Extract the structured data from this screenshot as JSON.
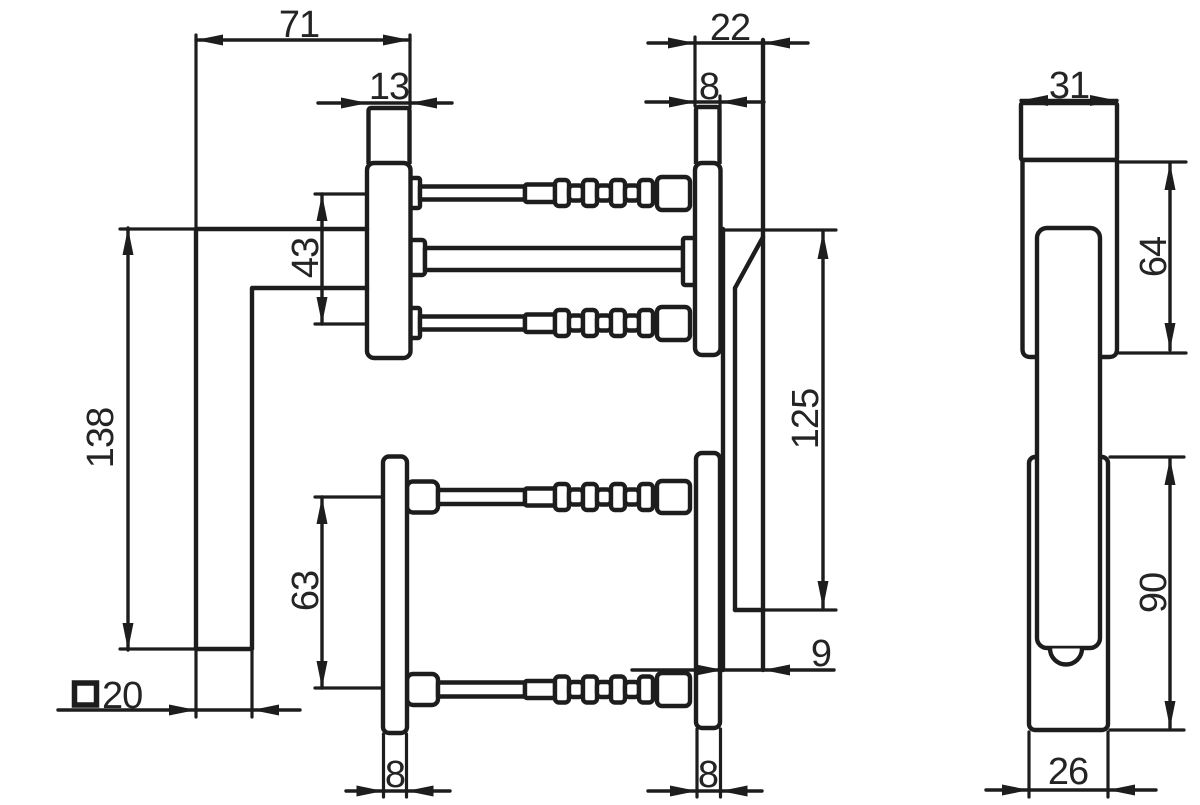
{
  "drawing": {
    "type": "technical-drawing-door-window-handle",
    "background_color": "#ffffff",
    "line_color": "#1d1d1d",
    "dims": {
      "handle_projection": "71",
      "rosette_thickness": "13",
      "screw_spacing_top": "43",
      "handle_height": "138",
      "grip_square_size": "20",
      "screw_spacing_bottom": "63",
      "rosette_width_bottom_left": "8",
      "outside_cap_depth": "22",
      "outside_plate_thickness": "8",
      "outside_cover_length": "125",
      "outside_cover_offset": "9",
      "outside_plate_width_bottom": "8",
      "front_top_escutcheon_width": "31",
      "front_top_escutcheon_height": "64",
      "front_bottom_escutcheon_height": "90",
      "front_bottom_escutcheon_width": "26"
    },
    "symbols": {
      "square_section": "square-symbol"
    }
  }
}
